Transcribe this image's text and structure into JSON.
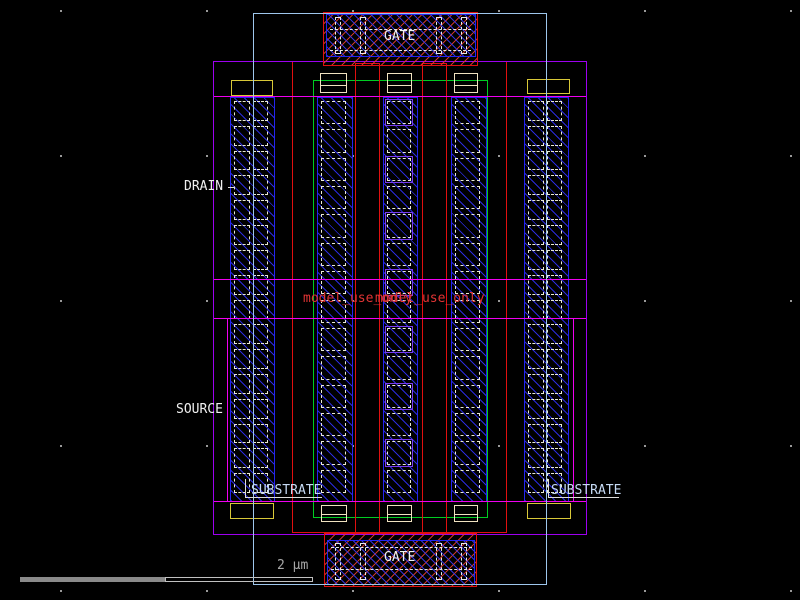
{
  "canvas": {
    "width": 800,
    "height": 600,
    "background": "#000000"
  },
  "colors": {
    "outer_boundary": "#9ec6ec",
    "well_purple": "#9d00f0",
    "region_magenta": "#f000f0",
    "poly_red": "#e01010",
    "metal_blue": "#2424f0",
    "diffusion_green": "#00cc22",
    "implant_yellow": "#d8c838",
    "contact_beige": "#f0e2c0",
    "contact_dash": "#e8e8d8",
    "leader_white": "#dcdcdc",
    "text_white": "#f0f0f0",
    "text_substrate": "#c6daf4",
    "text_red": "#e03434",
    "scalebar_fill": "#8a8a8a",
    "scalebar_outline": "#c0c0c0",
    "grid_dot": "#999999",
    "gate_marker_purple": "#7a3cf0"
  },
  "scene": {
    "grid": {
      "xs": [
        60,
        206,
        352,
        498,
        644,
        790
      ],
      "ys": [
        10,
        155,
        300,
        445,
        590
      ]
    },
    "columns": [
      {
        "name": "tap-column-left",
        "x": 230,
        "y": 97,
        "w": 45,
        "h": 405,
        "cols": 2,
        "rows": 16
      },
      {
        "name": "sd-column-1",
        "x": 317,
        "y": 97,
        "w": 36,
        "h": 405,
        "cols": 1,
        "rows": 14
      },
      {
        "name": "sd-column-2",
        "x": 383,
        "y": 97,
        "w": 35,
        "h": 405,
        "cols": 1,
        "rows": 14,
        "purple_cells": [
          0,
          2,
          4,
          6,
          8,
          10,
          12
        ]
      },
      {
        "name": "sd-column-3",
        "x": 451,
        "y": 97,
        "w": 36,
        "h": 405,
        "cols": 1,
        "rows": 14
      },
      {
        "name": "tap-column-right",
        "x": 524,
        "y": 97,
        "w": 45,
        "h": 405,
        "cols": 2,
        "rows": 16
      }
    ],
    "shapes": [
      {
        "name": "diffusion-outline-green",
        "type": "rect",
        "x": 313,
        "y": 80,
        "w": 175,
        "h": 438,
        "stroke": "#00cc22"
      },
      {
        "name": "poly-outer-red",
        "type": "rect",
        "x": 292,
        "y": 61,
        "w": 215,
        "h": 472,
        "stroke": "#e01010"
      },
      {
        "name": "poly-finger-1",
        "type": "rect",
        "x": 355,
        "y": 63,
        "w": 25,
        "h": 471,
        "stroke": "#e01010"
      },
      {
        "name": "poly-finger-2",
        "type": "rect",
        "x": 422,
        "y": 63,
        "w": 25,
        "h": 471,
        "stroke": "#e01010"
      },
      {
        "name": "drain-region-magenta",
        "type": "rect",
        "x": 213,
        "y": 96,
        "w": 374,
        "h": 184,
        "stroke": "#f000f0"
      },
      {
        "name": "source-region-magenta",
        "type": "rect",
        "x": 213,
        "y": 318,
        "w": 374,
        "h": 184,
        "stroke": "#f000f0"
      },
      {
        "name": "source-inner-edge-left",
        "type": "line-v",
        "x": 227,
        "y": 318,
        "len": 184,
        "color": "#f000f0"
      },
      {
        "name": "source-inner-edge-right",
        "type": "line-v",
        "x": 573,
        "y": 318,
        "len": 184,
        "color": "#f000f0"
      },
      {
        "name": "well-outline-purple",
        "type": "rect",
        "x": 213,
        "y": 61,
        "w": 374,
        "h": 474,
        "stroke": "#9d00f0"
      },
      {
        "name": "tap-implant-top-left",
        "type": "rect",
        "x": 231,
        "y": 80,
        "w": 42,
        "h": 16,
        "stroke": "#d8c838"
      },
      {
        "name": "tap-implant-top-right",
        "type": "rect",
        "x": 527,
        "y": 79,
        "w": 43,
        "h": 15,
        "stroke": "#d8c838"
      },
      {
        "name": "tap-implant-bottom-left",
        "type": "rect",
        "x": 230,
        "y": 503,
        "w": 44,
        "h": 16,
        "stroke": "#d8c838"
      },
      {
        "name": "tap-implant-bottom-right",
        "type": "rect",
        "x": 527,
        "y": 503,
        "w": 44,
        "h": 16,
        "stroke": "#d8c838"
      },
      {
        "name": "end-contact-top-1",
        "type": "rect",
        "x": 320,
        "y": 73,
        "w": 27,
        "h": 20,
        "stroke": "#f0e2c0"
      },
      {
        "name": "end-contact-top-2",
        "type": "rect",
        "x": 387,
        "y": 73,
        "w": 25,
        "h": 20,
        "stroke": "#f0e2c0"
      },
      {
        "name": "end-contact-top-3",
        "type": "rect",
        "x": 454,
        "y": 73,
        "w": 24,
        "h": 20,
        "stroke": "#f0e2c0"
      },
      {
        "name": "end-contact-top-1-divider",
        "type": "line-h",
        "x": 320,
        "y": 85,
        "len": 27,
        "color": "#f0e2c0"
      },
      {
        "name": "end-contact-top-2-divider",
        "type": "line-h",
        "x": 387,
        "y": 85,
        "len": 25,
        "color": "#f0e2c0"
      },
      {
        "name": "end-contact-top-3-divider",
        "type": "line-h",
        "x": 454,
        "y": 85,
        "len": 24,
        "color": "#f0e2c0"
      },
      {
        "name": "end-contact-bottom-1",
        "type": "rect",
        "x": 321,
        "y": 505,
        "w": 26,
        "h": 17,
        "stroke": "#f0e2c0"
      },
      {
        "name": "end-contact-bottom-2",
        "type": "rect",
        "x": 387,
        "y": 505,
        "w": 25,
        "h": 17,
        "stroke": "#f0e2c0"
      },
      {
        "name": "end-contact-bottom-3",
        "type": "rect",
        "x": 454,
        "y": 505,
        "w": 24,
        "h": 17,
        "stroke": "#f0e2c0"
      },
      {
        "name": "end-contact-bottom-1-divider",
        "type": "line-h",
        "x": 321,
        "y": 514,
        "len": 26,
        "color": "#f0e2c0"
      },
      {
        "name": "end-contact-bottom-2-divider",
        "type": "line-h",
        "x": 387,
        "y": 514,
        "len": 25,
        "color": "#f0e2c0"
      },
      {
        "name": "end-contact-bottom-3-divider",
        "type": "line-h",
        "x": 454,
        "y": 514,
        "len": 24,
        "color": "#f0e2c0"
      },
      {
        "name": "gate-plate-top-poly",
        "type": "rect",
        "x": 323,
        "y": 12,
        "w": 155,
        "h": 54,
        "stroke": "#e01010",
        "hatch": "red"
      },
      {
        "name": "gate-plate-top-metal",
        "type": "rect",
        "x": 326,
        "y": 14,
        "w": 150,
        "h": 43,
        "stroke": "#2424f0",
        "hatch": "blue"
      },
      {
        "name": "gate-top-dash-upper",
        "type": "dline-h",
        "x": 330,
        "y": 29,
        "len": 141,
        "color": "#e8e8e8"
      },
      {
        "name": "gate-top-dash-lower",
        "type": "dline-h",
        "x": 330,
        "y": 50,
        "len": 141,
        "color": "#e8e8e8"
      },
      {
        "name": "gate-top-via-1",
        "type": "rect-dash",
        "x": 335,
        "y": 17,
        "w": 6,
        "h": 37,
        "stroke": "#e8e8e8"
      },
      {
        "name": "gate-top-via-2",
        "type": "rect-dash",
        "x": 360,
        "y": 17,
        "w": 6,
        "h": 37,
        "stroke": "#e8e8e8"
      },
      {
        "name": "gate-top-via-3",
        "type": "rect-dash",
        "x": 436,
        "y": 17,
        "w": 6,
        "h": 37,
        "stroke": "#e8e8e8"
      },
      {
        "name": "gate-top-via-4",
        "type": "rect-dash",
        "x": 461,
        "y": 17,
        "w": 6,
        "h": 37,
        "stroke": "#e8e8e8"
      },
      {
        "name": "gate-plate-bottom-poly",
        "type": "rect",
        "x": 324,
        "y": 533,
        "w": 153,
        "h": 54,
        "stroke": "#e01010",
        "hatch": "red"
      },
      {
        "name": "gate-plate-bottom-metal",
        "type": "rect",
        "x": 327,
        "y": 540,
        "w": 148,
        "h": 45,
        "stroke": "#2424f0",
        "hatch": "blue"
      },
      {
        "name": "gate-bottom-dash-upper",
        "type": "dline-h",
        "x": 331,
        "y": 547,
        "len": 141,
        "color": "#e8e8e8"
      },
      {
        "name": "gate-bottom-dash-lower",
        "type": "dline-h",
        "x": 331,
        "y": 569,
        "len": 141,
        "color": "#e8e8e8"
      },
      {
        "name": "gate-bottom-via-1",
        "type": "rect-dash",
        "x": 335,
        "y": 543,
        "w": 6,
        "h": 37,
        "stroke": "#e8e8e8"
      },
      {
        "name": "gate-bottom-via-2",
        "type": "rect-dash",
        "x": 360,
        "y": 543,
        "w": 6,
        "h": 37,
        "stroke": "#e8e8e8"
      },
      {
        "name": "gate-bottom-via-3",
        "type": "rect-dash",
        "x": 436,
        "y": 543,
        "w": 6,
        "h": 37,
        "stroke": "#e8e8e8"
      },
      {
        "name": "gate-bottom-via-4",
        "type": "rect-dash",
        "x": 461,
        "y": 543,
        "w": 6,
        "h": 37,
        "stroke": "#e8e8e8"
      },
      {
        "name": "cell-boundary-lightblue",
        "type": "rect",
        "x": 253,
        "y": 13,
        "w": 294,
        "h": 572,
        "stroke": "#9ec6ec"
      },
      {
        "name": "substrate-left-leader-v",
        "type": "line-v",
        "x": 245,
        "y": 479,
        "len": 18,
        "color": "#dcdcdc"
      },
      {
        "name": "substrate-left-leader-h",
        "type": "line-h",
        "x": 245,
        "y": 497,
        "len": 77,
        "color": "#dcdcdc"
      },
      {
        "name": "substrate-right-leader-v",
        "type": "line-v",
        "x": 548,
        "y": 479,
        "len": 18,
        "color": "#dcdcdc"
      },
      {
        "name": "substrate-right-leader-h",
        "type": "line-h",
        "x": 548,
        "y": 497,
        "len": 71,
        "color": "#dcdcdc"
      },
      {
        "name": "drain-leader",
        "type": "line-h",
        "x": 228,
        "y": 187,
        "len": 6,
        "color": "#dcdcdc"
      },
      {
        "name": "scalebar-fill",
        "type": "rect",
        "x": 20,
        "y": 577,
        "w": 145,
        "h": 5,
        "fill": "#8a8a8a"
      },
      {
        "name": "scalebar-outline",
        "type": "rect",
        "x": 165,
        "y": 577,
        "w": 148,
        "h": 5,
        "stroke": "#c0c0c0"
      }
    ],
    "labels": [
      {
        "name": "label-gate-top",
        "text": "GATE",
        "x": 384,
        "y": 30,
        "color": "#f0f0f0"
      },
      {
        "name": "label-gate-bottom",
        "text": "GATE",
        "x": 384,
        "y": 551,
        "color": "#f0f0f0"
      },
      {
        "name": "label-drain",
        "text": "DRAIN",
        "x": 184,
        "y": 180,
        "color": "#f0f0f0"
      },
      {
        "name": "label-source",
        "text": "SOURCE",
        "x": 176,
        "y": 403,
        "color": "#f0f0f0"
      },
      {
        "name": "label-substrate-left",
        "text": "SUBSTRATE",
        "x": 251,
        "y": 484,
        "color": "#c6daf4"
      },
      {
        "name": "label-substrate-right",
        "text": "SUBSTRATE",
        "x": 551,
        "y": 484,
        "color": "#c6daf4"
      },
      {
        "name": "label-scale",
        "text": "2 μm",
        "x": 277,
        "y": 559,
        "color": "#a8a8a8"
      },
      {
        "name": "label-model-text-1",
        "text": "model_use_only",
        "x": 303,
        "y": 292,
        "color": "#e03434"
      },
      {
        "name": "label-model-text-2",
        "text": "model_use_only",
        "x": 375,
        "y": 292,
        "color": "#e03434"
      }
    ]
  }
}
